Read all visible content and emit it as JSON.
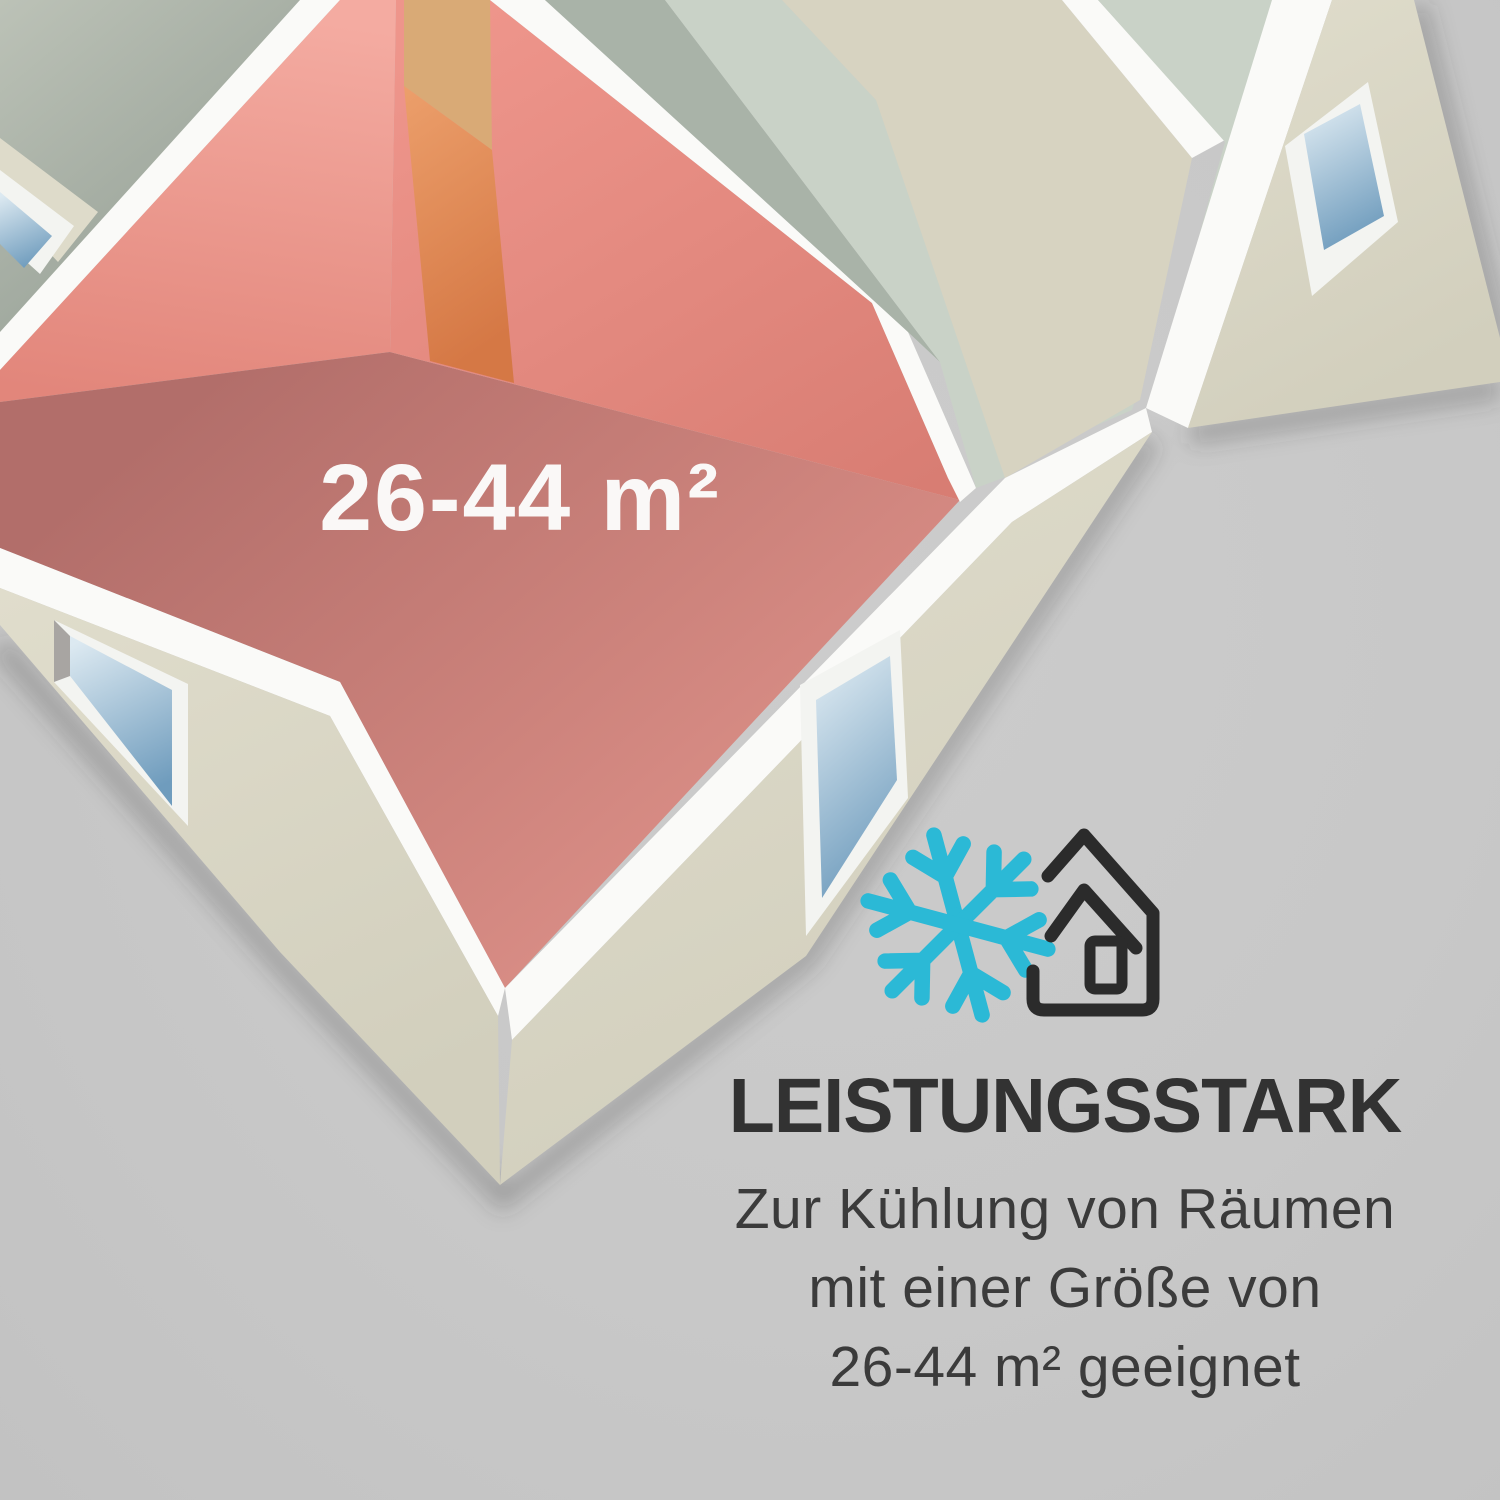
{
  "scene": {
    "background_color": "#c8c8c8",
    "description": "Isometric 3D floor plan with highlighted room and cooling info text"
  },
  "floor_plan": {
    "highlighted_room": {
      "area_label": "26-44 m²",
      "label_color": "#faf8f7",
      "floor_color": "#c87f79",
      "wall_color": "#ec9288",
      "door_color": "#e08c55"
    },
    "palette": {
      "wall_top": "#fafaf8",
      "exterior_wall": "#dedbca",
      "top_left_room_floor": "#a5afa4",
      "corridor_dark": "#a9b3a8",
      "corridor_light": "#c9d2c7",
      "large_room_floor": "#d7d3c1",
      "door_floor": "#d9aa76",
      "window_frame": "#f3f4f1",
      "window_glass_top": "#dce9f1",
      "window_glass_bottom": "#6f9cbd",
      "window_jamb": "#a8a5a2"
    }
  },
  "info_section": {
    "snowflake_color": "#2bb9d6",
    "house_color": "#2b2b2b",
    "heading": "LEISTUNGSSTARK",
    "heading_color": "#323232",
    "body_lines": [
      "Zur Kühlung von Räumen",
      "mit einer Größe von",
      "26-44 m² geeignet"
    ],
    "body_color": "#3b3b3b"
  }
}
